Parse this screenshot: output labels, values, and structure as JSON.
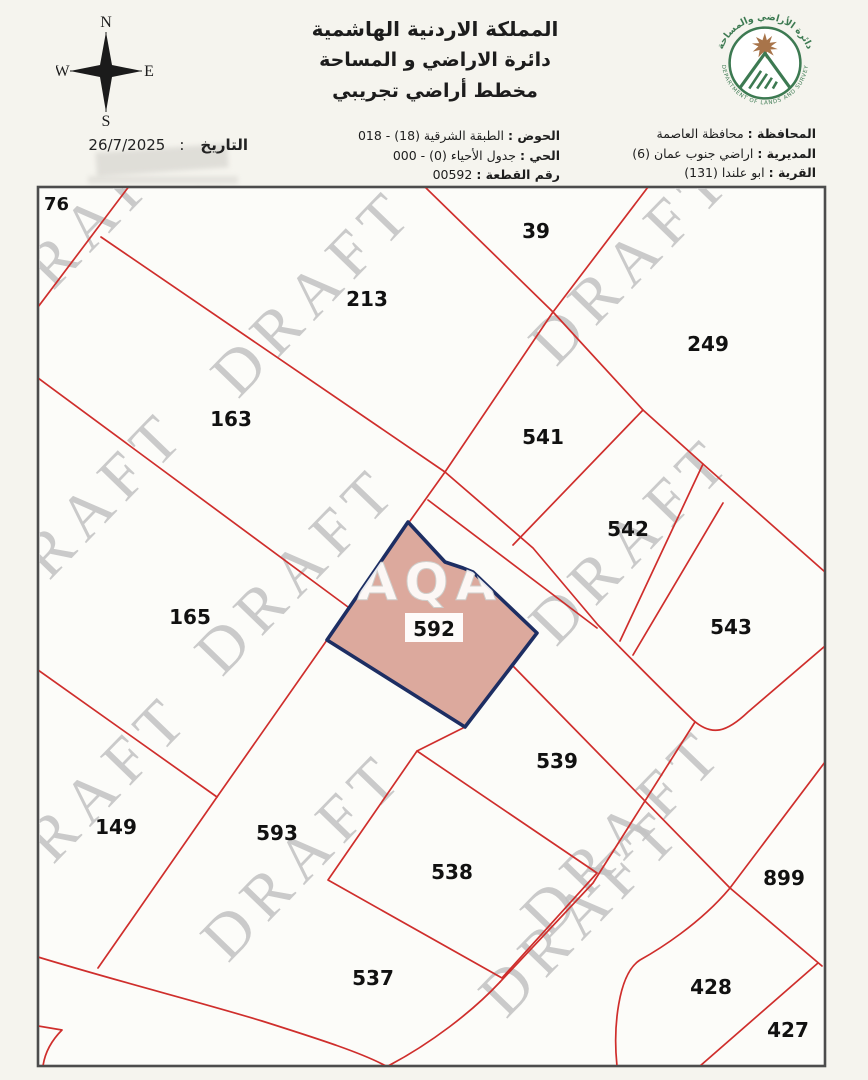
{
  "header": {
    "kingdom": "المملكة الاردنية الهاشمية",
    "department": "دائرة الاراضي و المساحة",
    "plan_type": "مخطط أراضي تجريبي"
  },
  "date": {
    "label": "التاريخ",
    "colon": ":",
    "value": "26/7/2025"
  },
  "compass": {
    "north": "N",
    "south": "S",
    "east": "E",
    "west": "W"
  },
  "logo": {
    "arabic": "دائرة الأراضي والمساحة",
    "english": "DEPARTMENT OF LANDS AND SURVEY"
  },
  "plan_info": [
    {
      "label": "الحوض :",
      "value": "الطبقة الشرقية (18) - 018"
    },
    {
      "label": "الحي :",
      "value": "جدول الأحياء (0) - 000"
    },
    {
      "label": "رقم القطعة :",
      "value": "00592"
    }
  ],
  "location_info": [
    {
      "label": "المحافظة :",
      "value": "محافظة العاصمة"
    },
    {
      "label": "المديرية :",
      "value": "اراضي جنوب عمان (6)"
    },
    {
      "label": "القرية :",
      "value": "ابو علندا (131)"
    }
  ],
  "map": {
    "watermark": "DRAFT",
    "overlay_watermark": "AQA",
    "highlighted_parcel": "592",
    "colors": {
      "boundary_red": "#cf2e2c",
      "highlight_fill": "#d9a295",
      "highlight_border": "#1d2e63",
      "watermark_gray": "#c4c4c4"
    },
    "parcels": [
      {
        "id": "76"
      },
      {
        "id": "213"
      },
      {
        "id": "39"
      },
      {
        "id": "249"
      },
      {
        "id": "163"
      },
      {
        "id": "541"
      },
      {
        "id": "542"
      },
      {
        "id": "543"
      },
      {
        "id": "165"
      },
      {
        "id": "592"
      },
      {
        "id": "539"
      },
      {
        "id": "149"
      },
      {
        "id": "593"
      },
      {
        "id": "538"
      },
      {
        "id": "899"
      },
      {
        "id": "537"
      },
      {
        "id": "428"
      },
      {
        "id": "427"
      }
    ]
  }
}
